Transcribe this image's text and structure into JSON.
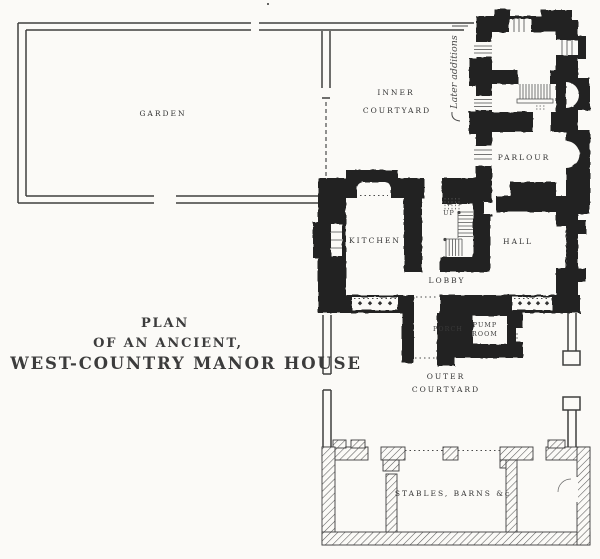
{
  "title": {
    "line1": "PLAN",
    "line2": "OF AN ANCIENT,",
    "line3": "WEST-COUNTRY MANOR HOUSE"
  },
  "rooms": {
    "garden": "GARDEN",
    "inner_courtyard_line1": "INNER",
    "inner_courtyard_line2": "COURTYARD",
    "parlour": "PARLOUR",
    "kitchen": "KITCHEN",
    "hall": "HALL",
    "lobby": "LOBBY",
    "up": "UP",
    "porch": "PORCH",
    "pump_room_line1": "PUMP",
    "pump_room_line2": "ROOM",
    "outer_courtyard_line1": "OUTER",
    "outer_courtyard_line2": "COURTYARD",
    "stables": "STABLES, BARNS &c"
  },
  "annotations": {
    "later_additions": "Later additions"
  },
  "colors": {
    "ink": "#242424",
    "paper": "#fbfaf7",
    "label_ink": "#333333"
  }
}
